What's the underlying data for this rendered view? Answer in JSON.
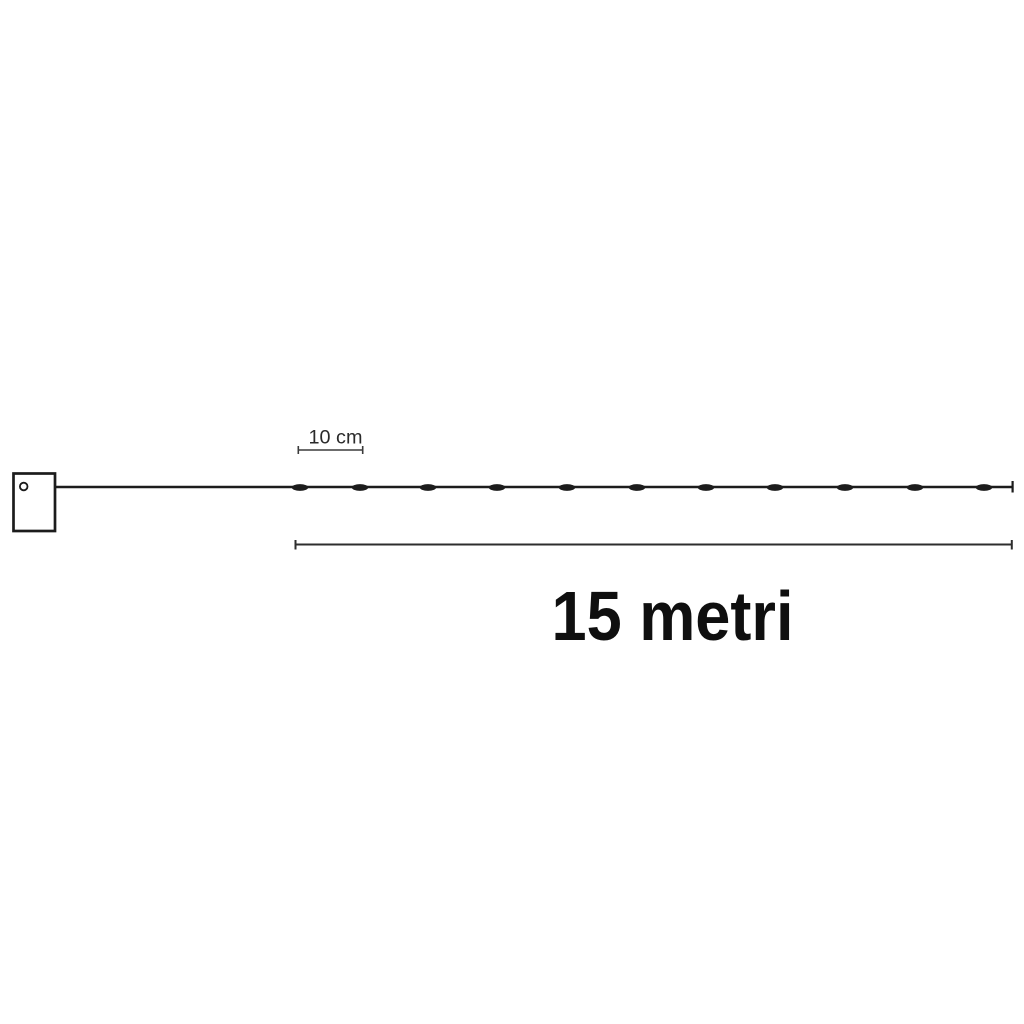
{
  "diagram": {
    "type": "product-dimension-diagram",
    "subject": "string lights with controller box",
    "spacing_label": "10 cm",
    "length_label": "15 metri",
    "led_count": 11,
    "led_positions_px": [
      300,
      360,
      428,
      497,
      567,
      637,
      706,
      775,
      845,
      915,
      984
    ],
    "wire": {
      "start_x": 55,
      "end_x": 1012.5,
      "y": 487
    },
    "spacing_dimension": {
      "x1": 298,
      "x2": 363,
      "y": 450
    },
    "length_dimension": {
      "x1": 295.5,
      "x2": 1012,
      "y": 544.5
    },
    "controller_box": {
      "x": 12,
      "y": 472,
      "width": 44,
      "height": 60
    }
  },
  "colors": {
    "background": "#ffffff",
    "ink": "#1c1c1c",
    "dim-line": "#3c3c3c",
    "dim-line-strong": "#2e2e2e",
    "small-label": "#2a2a2a",
    "big-label": "#0f0f0f"
  }
}
